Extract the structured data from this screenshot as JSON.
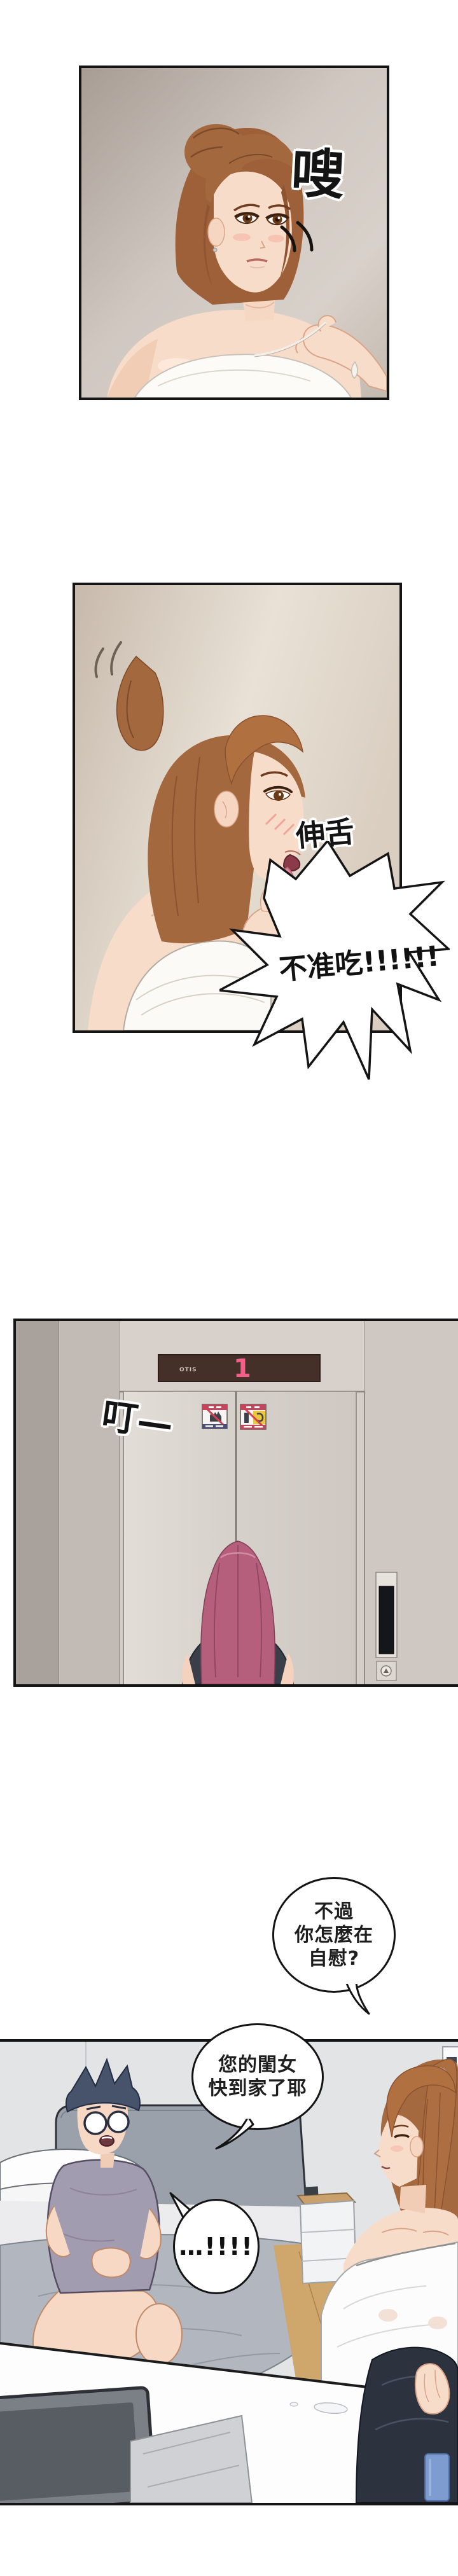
{
  "sfx": {
    "whoosh": "嗖",
    "lick": "伸舌",
    "ding": "叮—"
  },
  "bubbles": {
    "forbid": "不准吃!!!!!!",
    "question": {
      "l1": "不過",
      "l2": "你怎麼在",
      "l3": "自慰?"
    },
    "daughter": {
      "l1": "您的閨女",
      "l2": "快到家了耶"
    },
    "shock": "…!!!!"
  },
  "elevator": {
    "brand": "OTIS",
    "floor": "1"
  },
  "colors": {
    "panel_border": "#141414",
    "floor_digit": "#f2608a",
    "indicator_bg": "#453029",
    "hair_brown": "#a4683f",
    "hair_pink": "#b55f7d",
    "man_hair": "#46536b",
    "bubble_fill": "#ffffff"
  }
}
